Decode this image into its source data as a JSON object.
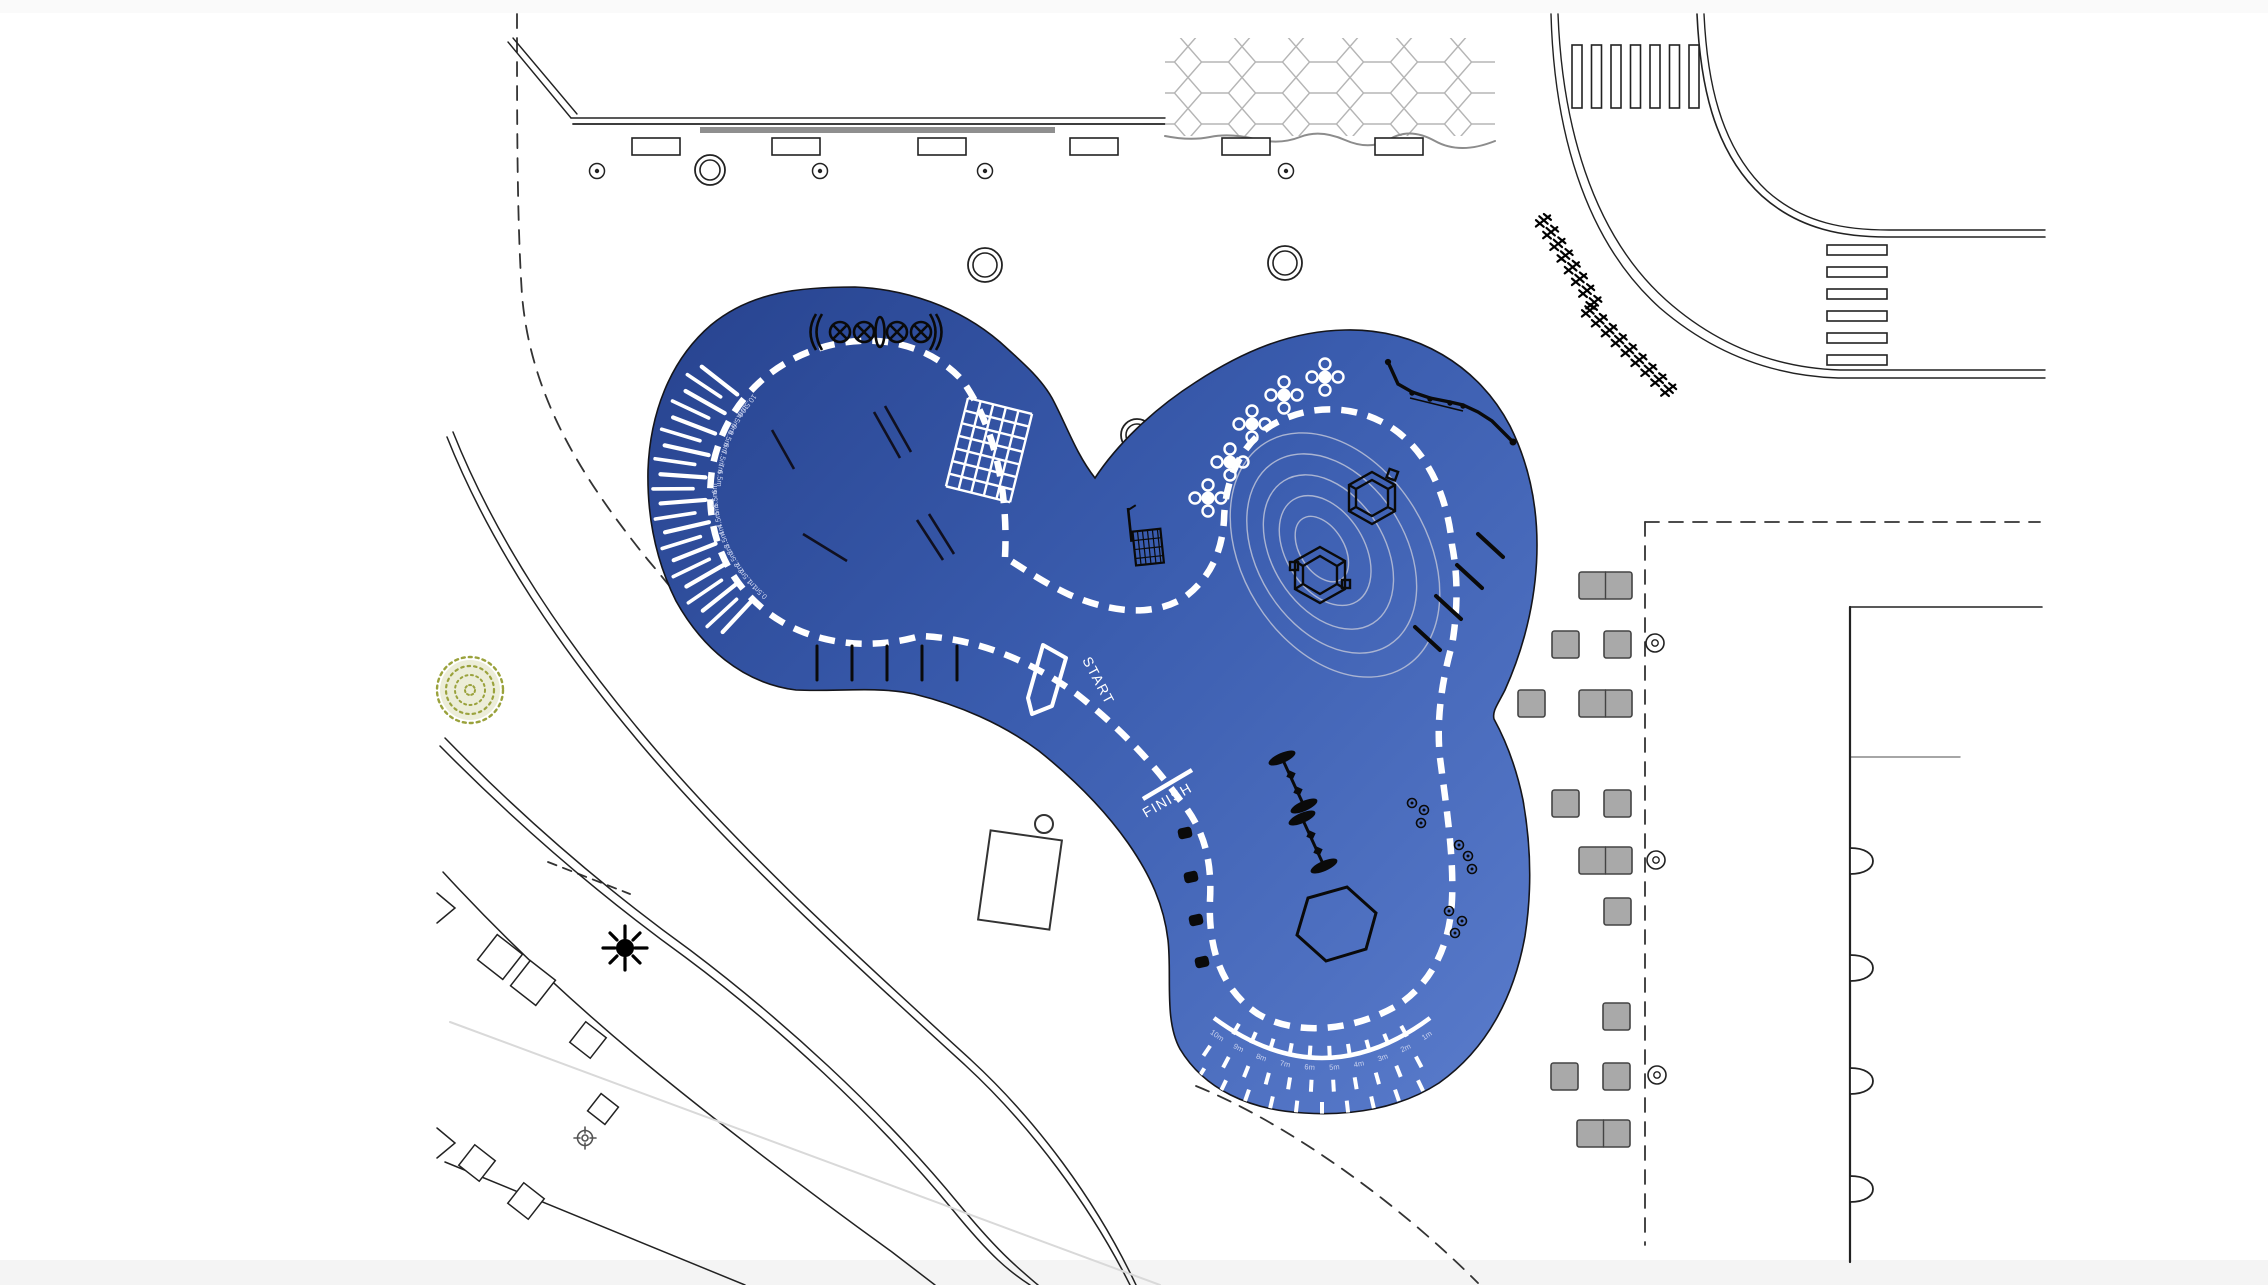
{
  "plan": {
    "track": {
      "start_label": "START",
      "finish_label": "FINISH"
    },
    "distance_scale": {
      "labels": [
        "10.5m",
        "10m",
        "9.5m",
        "9m",
        "8.5m",
        "8m",
        "7.5m",
        "7m",
        "6.5m",
        "6m",
        "5.5m",
        "5m",
        "4.5m",
        "4m",
        "3.5m",
        "3m",
        "2.5m",
        "2m",
        "1.5m",
        "1m",
        "0.5m"
      ]
    },
    "throw_fan": {
      "labels": [
        "10m",
        "9m",
        "8m",
        "7m",
        "6m",
        "5m",
        "4m",
        "3m",
        "2m",
        "1m"
      ]
    },
    "colors": {
      "surface_dark": "#27438f",
      "surface_mid": "#3a5cae",
      "surface_light": "#5a7ccc",
      "track_white": "#ffffff",
      "contour": "#aab4d2",
      "table_fill": "#a9a9a9",
      "tree_green": "#9aa23c",
      "paving_line": "#b5b5b5",
      "line_dark": "#222222"
    },
    "features": [
      "spinner-row",
      "climbing-net",
      "balance-beams",
      "ball-basket",
      "rope-bridge",
      "flower-spinners",
      "climbing-hexagons",
      "mound-contours",
      "seesaws",
      "play-hexagon",
      "throw-fan",
      "distance-scale",
      "running-track",
      "amphitheatre-fan"
    ]
  }
}
